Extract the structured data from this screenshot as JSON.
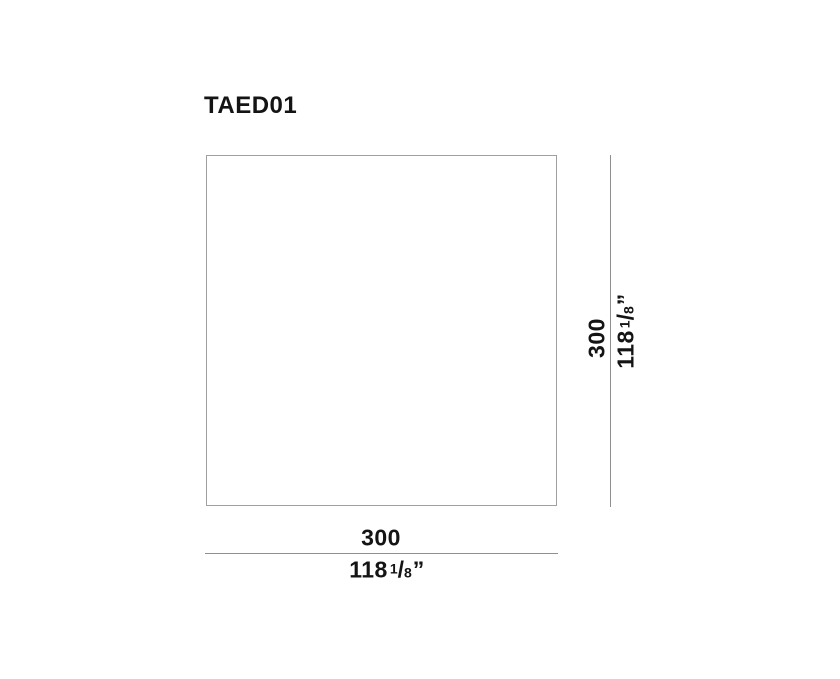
{
  "page": {
    "background": "#ffffff"
  },
  "drawing": {
    "title": "TAED01",
    "fraction_slash": "/",
    "inch_mark": "”",
    "width_dimension": {
      "metric": "300",
      "imperial_whole": "118",
      "imperial_numerator": "1",
      "imperial_denominator": "8"
    },
    "height_dimension": {
      "metric": "300",
      "imperial_whole": "118",
      "imperial_numerator": "1",
      "imperial_denominator": "8"
    },
    "colors": {
      "text": "#141414",
      "outline": "#a0a0a0",
      "dimension_line": "#8f8f8f"
    }
  }
}
